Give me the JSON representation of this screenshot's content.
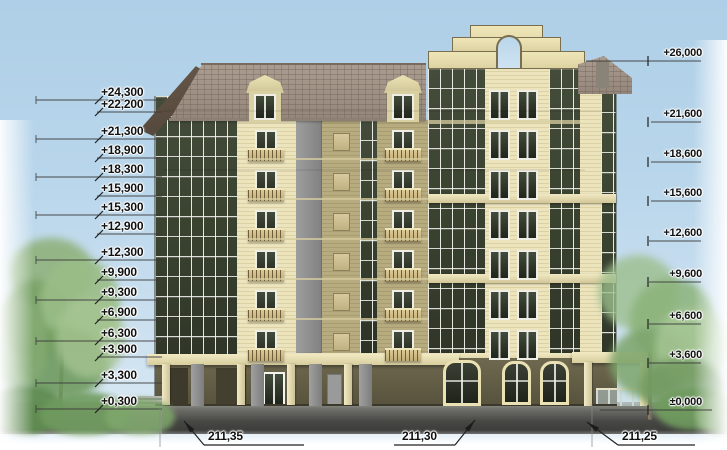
{
  "drawing": {
    "name": "building-facade-elevation",
    "view": "street elevation of a nine-storey residential building with mansard roof, arched parapet, glazed loggias and trees",
    "left_elevation_marks": [
      {
        "label": "+24,300",
        "y": 93,
        "long": true
      },
      {
        "label": "+22,200",
        "y": 105,
        "long": false
      },
      {
        "label": "+21,300",
        "y": 132,
        "long": true
      },
      {
        "label": "+18,900",
        "y": 151,
        "long": false
      },
      {
        "label": "+18,300",
        "y": 170,
        "long": true
      },
      {
        "label": "+15,900",
        "y": 189,
        "long": false
      },
      {
        "label": "+15,300",
        "y": 208,
        "long": true
      },
      {
        "label": "+12,900",
        "y": 227,
        "long": false
      },
      {
        "label": "+12,300",
        "y": 253,
        "long": true
      },
      {
        "label": "+9,900",
        "y": 273,
        "long": false
      },
      {
        "label": "+9,300",
        "y": 293,
        "long": true
      },
      {
        "label": "+6,900",
        "y": 313,
        "long": false
      },
      {
        "label": "+6,300",
        "y": 334,
        "long": true
      },
      {
        "label": "+3,900",
        "y": 350,
        "long": false
      },
      {
        "label": "+3,300",
        "y": 376,
        "long": true
      },
      {
        "label": "+0,300",
        "y": 402,
        "long": true
      }
    ],
    "right_elevation_marks": [
      {
        "label": "+26,000",
        "y": 54,
        "x1": 586,
        "x2": 701
      },
      {
        "label": "+21,600",
        "y": 115,
        "x1": 651,
        "x2": 701
      },
      {
        "label": "+18,600",
        "y": 155,
        "x1": 651,
        "x2": 701
      },
      {
        "label": "+15,600",
        "y": 194,
        "x1": 651,
        "x2": 701
      },
      {
        "label": "+12,600",
        "y": 234,
        "x1": 649,
        "x2": 701
      },
      {
        "label": "+9,600",
        "y": 275,
        "x1": 649,
        "x2": 701
      },
      {
        "label": "+6,600",
        "y": 317,
        "x1": 649,
        "x2": 701
      },
      {
        "label": "+3,600",
        "y": 356,
        "x1": 649,
        "x2": 701
      },
      {
        "label": "±0,000",
        "y": 403,
        "x1": 600,
        "x2": 712
      }
    ],
    "spot_elevations": [
      {
        "label": "211,35",
        "text_x": 208,
        "text_y": 429,
        "shelf_x1": 204,
        "shelf_x2": 304,
        "shelf_y": 445,
        "arrow_x": 184,
        "arrow_y": 421,
        "side": "left"
      },
      {
        "label": "211,30",
        "text_x": 402,
        "text_y": 429,
        "shelf_x1": 394,
        "shelf_x2": 455,
        "shelf_y": 445,
        "arrow_x": 475,
        "arrow_y": 420,
        "side": "right"
      },
      {
        "label": "211,25",
        "text_x": 622,
        "text_y": 429,
        "shelf_x1": 618,
        "shelf_x2": 695,
        "shelf_y": 445,
        "arrow_x": 587,
        "arrow_y": 422,
        "side": "left"
      }
    ],
    "colors": {
      "sky": "#b4d3e9",
      "wall_cream": "#e9e1ba",
      "wall_tan": "#b2a67a",
      "glazing_dark": "#323a2b",
      "roof_taupe": "#a0938a",
      "parapet_cream": "#e9dfae",
      "ground_floor_olive": "#6a6449",
      "pavement_grey": "#4a4a47",
      "foliage_green": "#7fa56d",
      "dimension_text": "#111111"
    }
  }
}
